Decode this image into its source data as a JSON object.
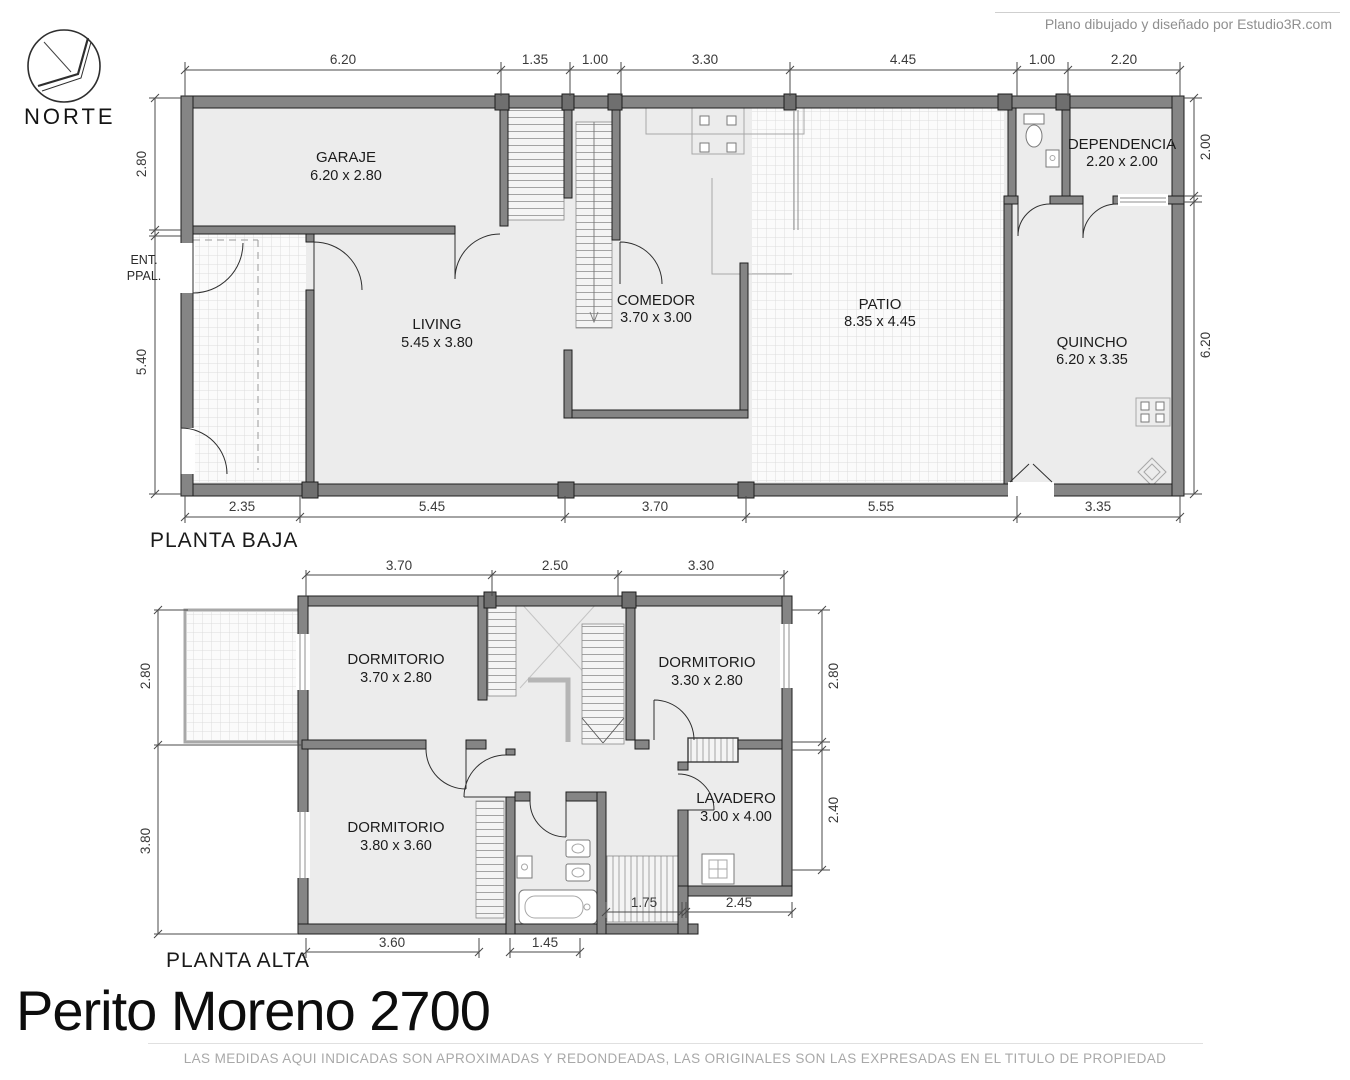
{
  "page": {
    "credit": "Plano dibujado y diseñado por Estudio3R.com",
    "title": "Perito Moreno 2700",
    "disclaimer": "LAS MEDIDAS AQUI INDICADAS SON APROXIMADAS Y REDONDEADAS, LAS ORIGINALES SON LAS EXPRESADAS EN EL TITULO DE PROPIEDAD"
  },
  "compass": {
    "label": "NORTE"
  },
  "colors": {
    "wall": "#858585",
    "wall_edge": "#1e1e1e",
    "floor": "#ececec",
    "tile_bg": "#fbfbfb",
    "tile_line": "#dcdcdc",
    "dim_text": "#3a3a3a",
    "muted_text": "#a8a8a8"
  },
  "ground_floor": {
    "label": "PLANTA BAJA",
    "entrance": {
      "line1": "ENT.",
      "line2": "PPAL."
    },
    "rooms": {
      "garaje": {
        "name": "GARAJE",
        "size": "6.20 x 2.80"
      },
      "living": {
        "name": "LIVING",
        "size": "5.45 x 3.80"
      },
      "comedor": {
        "name": "COMEDOR",
        "size": "3.70 x 3.00"
      },
      "patio": {
        "name": "PATIO",
        "size": "8.35 x 4.45"
      },
      "quincho": {
        "name": "QUINCHO",
        "size": "6.20 x 3.35"
      },
      "dependencia": {
        "name": "DEPENDENCIA",
        "size": "2.20 x 2.00"
      }
    },
    "dims": {
      "top": [
        "6.20",
        "1.35",
        "1.00",
        "3.30",
        "4.45",
        "1.00",
        "2.20"
      ],
      "bottom": [
        "2.35",
        "5.45",
        "3.70",
        "5.55",
        "3.35"
      ],
      "left": [
        "2.80",
        "5.40"
      ],
      "right": [
        "2.00",
        "6.20"
      ]
    }
  },
  "upper_floor": {
    "label": "PLANTA ALTA",
    "rooms": {
      "dormitorio1": {
        "name": "DORMITORIO",
        "size": "3.70 x 2.80"
      },
      "dormitorio2": {
        "name": "DORMITORIO",
        "size": "3.30 x 2.80"
      },
      "dormitorio3": {
        "name": "DORMITORIO",
        "size": "3.80 x 3.60"
      },
      "lavadero": {
        "name": "LAVADERO",
        "size": "3.00 x 4.00"
      }
    },
    "dims": {
      "top": [
        "3.70",
        "2.50",
        "3.30"
      ],
      "bottom_outer": [
        "3.60",
        "1.45"
      ],
      "bottom_inner": [
        "1.75",
        "2.45"
      ],
      "left": [
        "2.80",
        "3.80"
      ],
      "right": [
        "2.80",
        "2.40"
      ]
    }
  }
}
